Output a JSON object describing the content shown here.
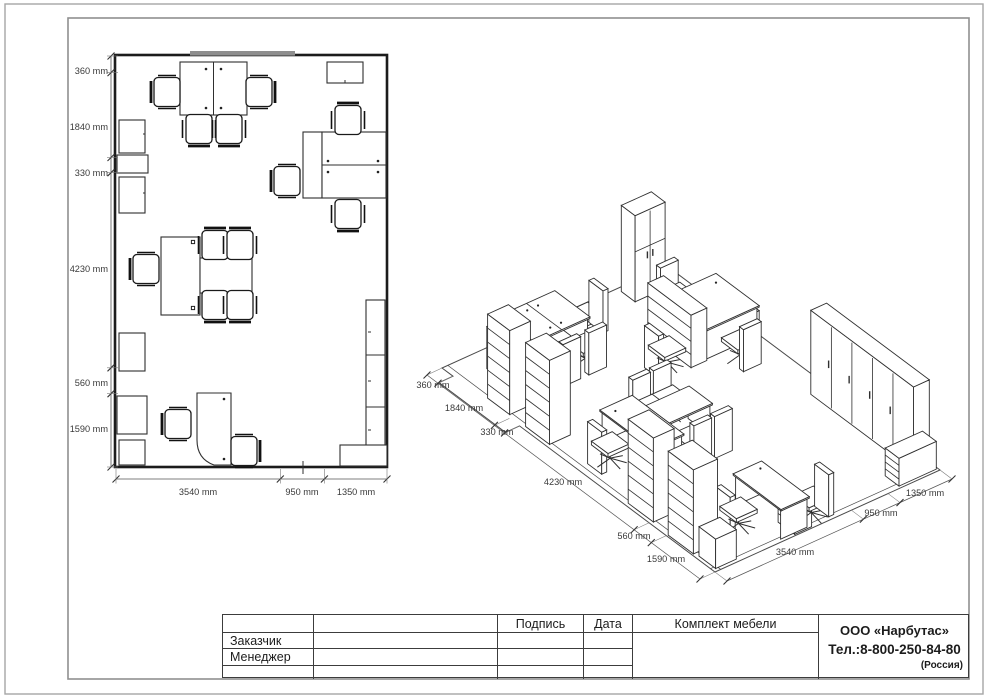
{
  "plan": {
    "v_dims": [
      "360 mm",
      "1840 mm",
      "330 mm",
      "4230 mm",
      "560 mm",
      "1590 mm"
    ],
    "h_dims": [
      "3540 mm",
      "950 mm",
      "1350 mm"
    ]
  },
  "iso": {
    "left_dims": [
      "360 mm",
      "1840 mm",
      "330 mm",
      "4230 mm",
      "560 mm",
      "1590 mm"
    ],
    "bottom_dims": [
      "3540 mm",
      "950 mm",
      "1350 mm"
    ]
  },
  "title_block": {
    "signature": "Подпись",
    "date": "Дата",
    "customer": "Заказчик",
    "manager": "Менеджер",
    "furniture_set": "Комплект мебели",
    "company": "ООО «Нарбутас»",
    "phone": "Тел.:8-800-250-84-80",
    "country": "(Россия)"
  },
  "colors": {
    "line": "#2f2f2f",
    "frame": "#9a9a9a",
    "window": "#8e8e8e",
    "text": "#3a3a3a"
  }
}
